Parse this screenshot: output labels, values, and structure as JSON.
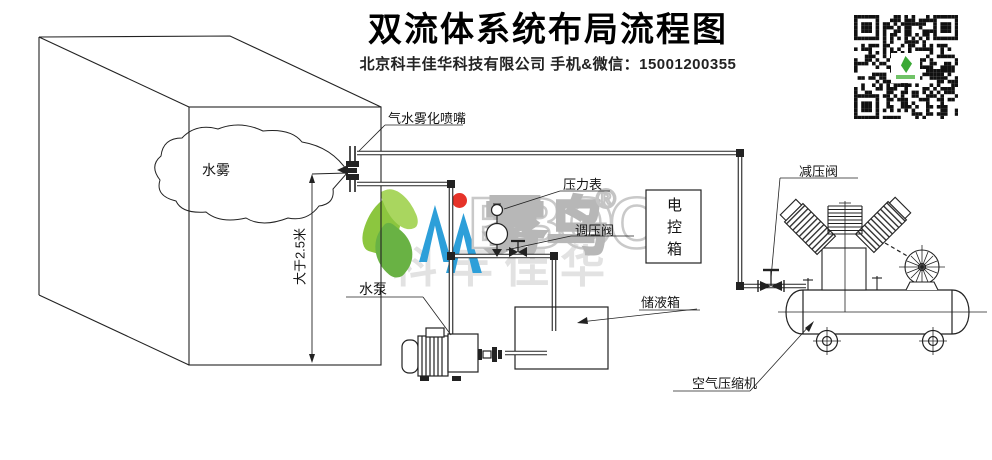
{
  "header": {
    "title": "双流体系统布局流程图",
    "subtitle": "北京科丰佳华科技有限公司 手机&微信：15001200355"
  },
  "labels": {
    "nozzle": "气水雾化喷嘴",
    "mist": "水雾",
    "height": "大于2.5米",
    "pressure_gauge": "压力表",
    "regulating_valve": "调压阀",
    "control_box": "电控箱",
    "water_pump": "水泵",
    "storage_tank": "储液箱",
    "reducing_valve": "减压阀",
    "air_compressor": "空气压缩机"
  },
  "watermark": {
    "blue_letter": "N",
    "gray_letters": "EBOO",
    "cjk": "雾鸟",
    "registered": "®",
    "company": "科丰佳华"
  },
  "colors": {
    "line": "#222222",
    "leaf_green": "#8bc53f",
    "logo_blue": "#2d9fd9",
    "logo_red": "#e63329",
    "watermark_gray": "#c6c6c6"
  }
}
